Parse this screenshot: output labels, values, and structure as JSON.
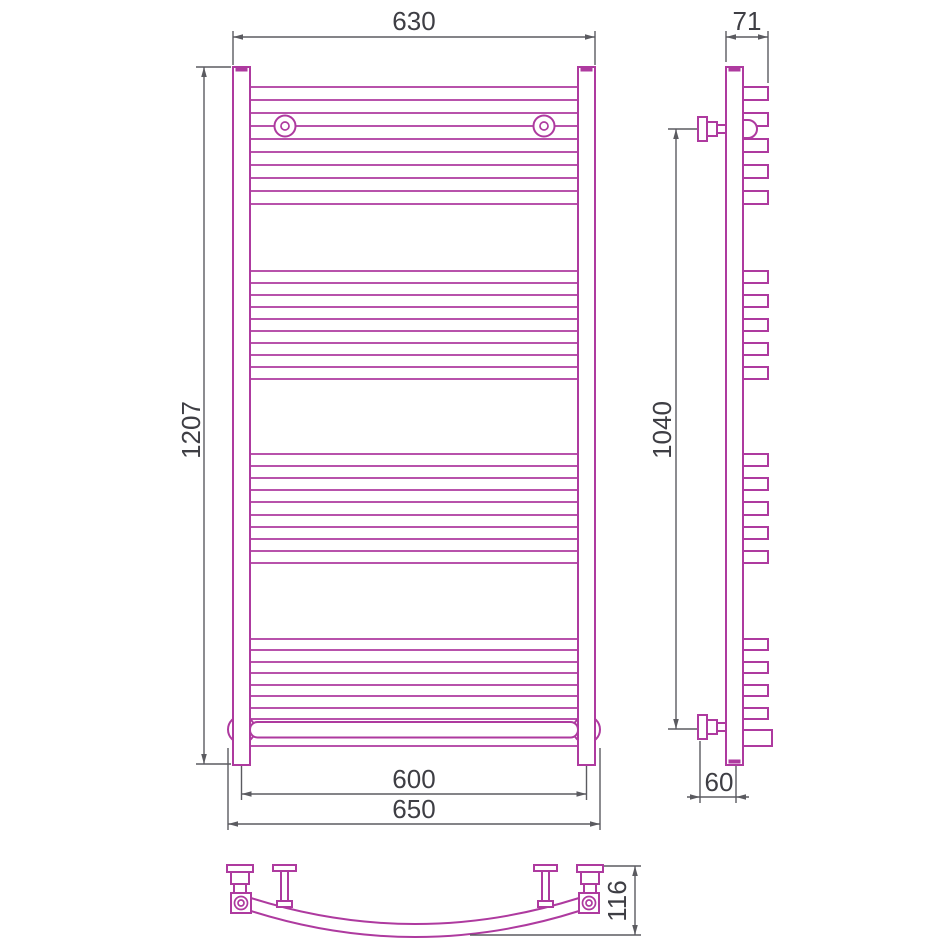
{
  "colors": {
    "outline": "#ae3a9f",
    "dimension_line": "#5b5b60",
    "label_text": "#3e3e44",
    "background": "#ffffff"
  },
  "views": {
    "front": {
      "dimensions": {
        "top_width": "630",
        "height": "1207",
        "bottom_inner_width": "600",
        "bottom_outer_width": "650"
      }
    },
    "side": {
      "dimensions": {
        "depth": "71",
        "mounting_height": "1040",
        "wall_offset": "60"
      }
    },
    "bottom": {
      "dimensions": {
        "arc_depth": "116"
      }
    }
  }
}
